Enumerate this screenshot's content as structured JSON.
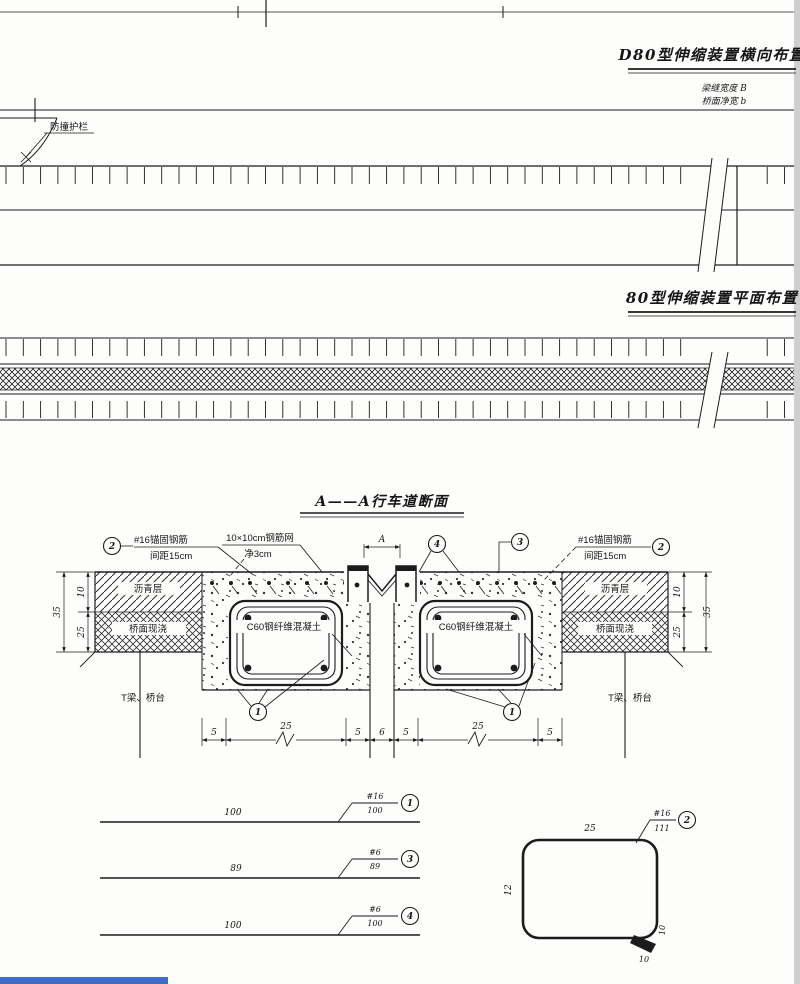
{
  "canvas": {
    "bg": "#fdfdfc",
    "line": "#1c1c1c",
    "accent_blue": "#3f6cc9",
    "edge_gray": "#cfcfcf"
  },
  "titles": {
    "transverse": "D80型伸缩装置横向布置",
    "plan": "80型伸缩装置平面布置",
    "section": "A——A行车道断面"
  },
  "notes": {
    "line1": "梁缝宽度 B",
    "line2": "桥面净宽 b"
  },
  "labels": {
    "barrier": "防撞护栏",
    "anchor_rebar_line1": "#16锚固钢筋",
    "anchor_rebar_line2": "间距15cm",
    "mesh_line1": "10×10cm钢筋网",
    "mesh_line2": "净3cm",
    "asphalt": "沥青层",
    "deck_pour": "桥面现浇",
    "c60": "C60钢纤维混凝土",
    "tbeam": "T梁、桥台",
    "gap_mark": "A"
  },
  "callouts": {
    "c1": "1",
    "c2": "2",
    "c3": "3",
    "c4": "4"
  },
  "dimensions": {
    "bottom": [
      "5",
      "25",
      "5",
      "6",
      "5",
      "25",
      "5"
    ],
    "layer_top": "10",
    "layer_bottom": "25",
    "layer_total": "35"
  },
  "details": {
    "bars": [
      {
        "length": "100",
        "spec": "#16",
        "total": "100",
        "no": "1"
      },
      {
        "length": "89",
        "spec": "#6",
        "total": "89",
        "no": "3"
      },
      {
        "length": "100",
        "spec": "#6",
        "total": "100",
        "no": "4"
      }
    ],
    "stirrup": {
      "width": "25",
      "height": "12",
      "spec": "#16",
      "total": "111",
      "no": "2",
      "hook": "10",
      "hook_side": "10"
    }
  }
}
